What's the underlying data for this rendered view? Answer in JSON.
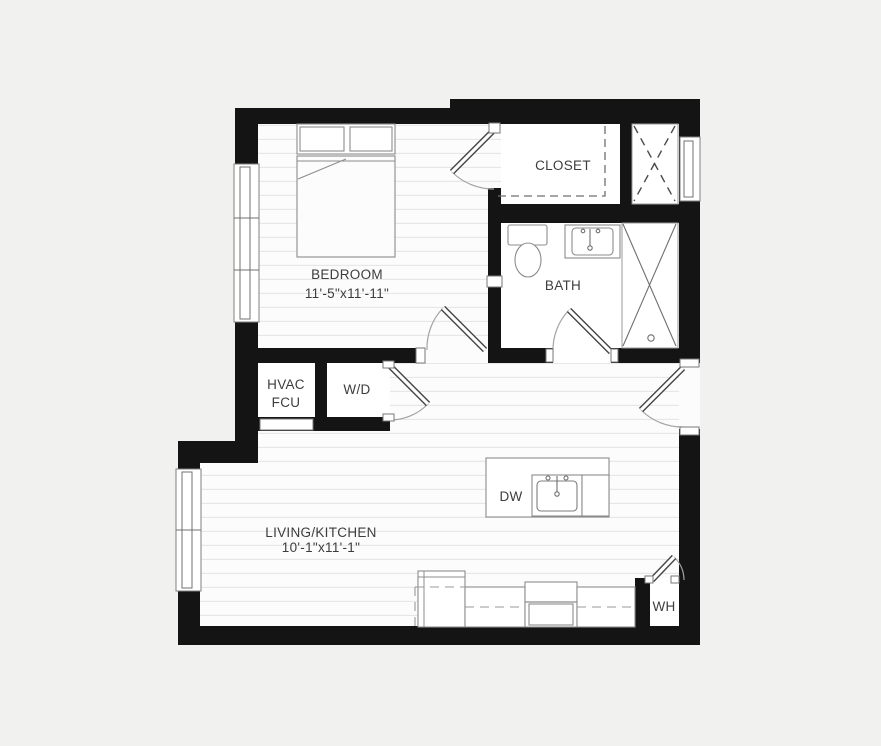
{
  "rooms": {
    "bedroom": {
      "name": "BEDROOM",
      "dims": "11'-5\"x11'-11\""
    },
    "closet": {
      "name": "CLOSET"
    },
    "bath": {
      "name": "BATH"
    },
    "hvac": {
      "line1": "HVAC",
      "line2": "FCU"
    },
    "washer_dryer": {
      "name": "W/D"
    },
    "living_kitchen": {
      "name": "LIVING/KITCHEN",
      "dims": "10'-1\"x11'-1\""
    },
    "dishwasher": {
      "name": "DW"
    },
    "water_heater": {
      "name": "WH"
    }
  },
  "colors": {
    "wall": "#141414",
    "floor": "#fcfcfc",
    "floor_stripe": "#e6e6e6",
    "fixture_line": "#8c8c8c",
    "background": "#f1f1f0",
    "text": "#3d3d3d"
  }
}
